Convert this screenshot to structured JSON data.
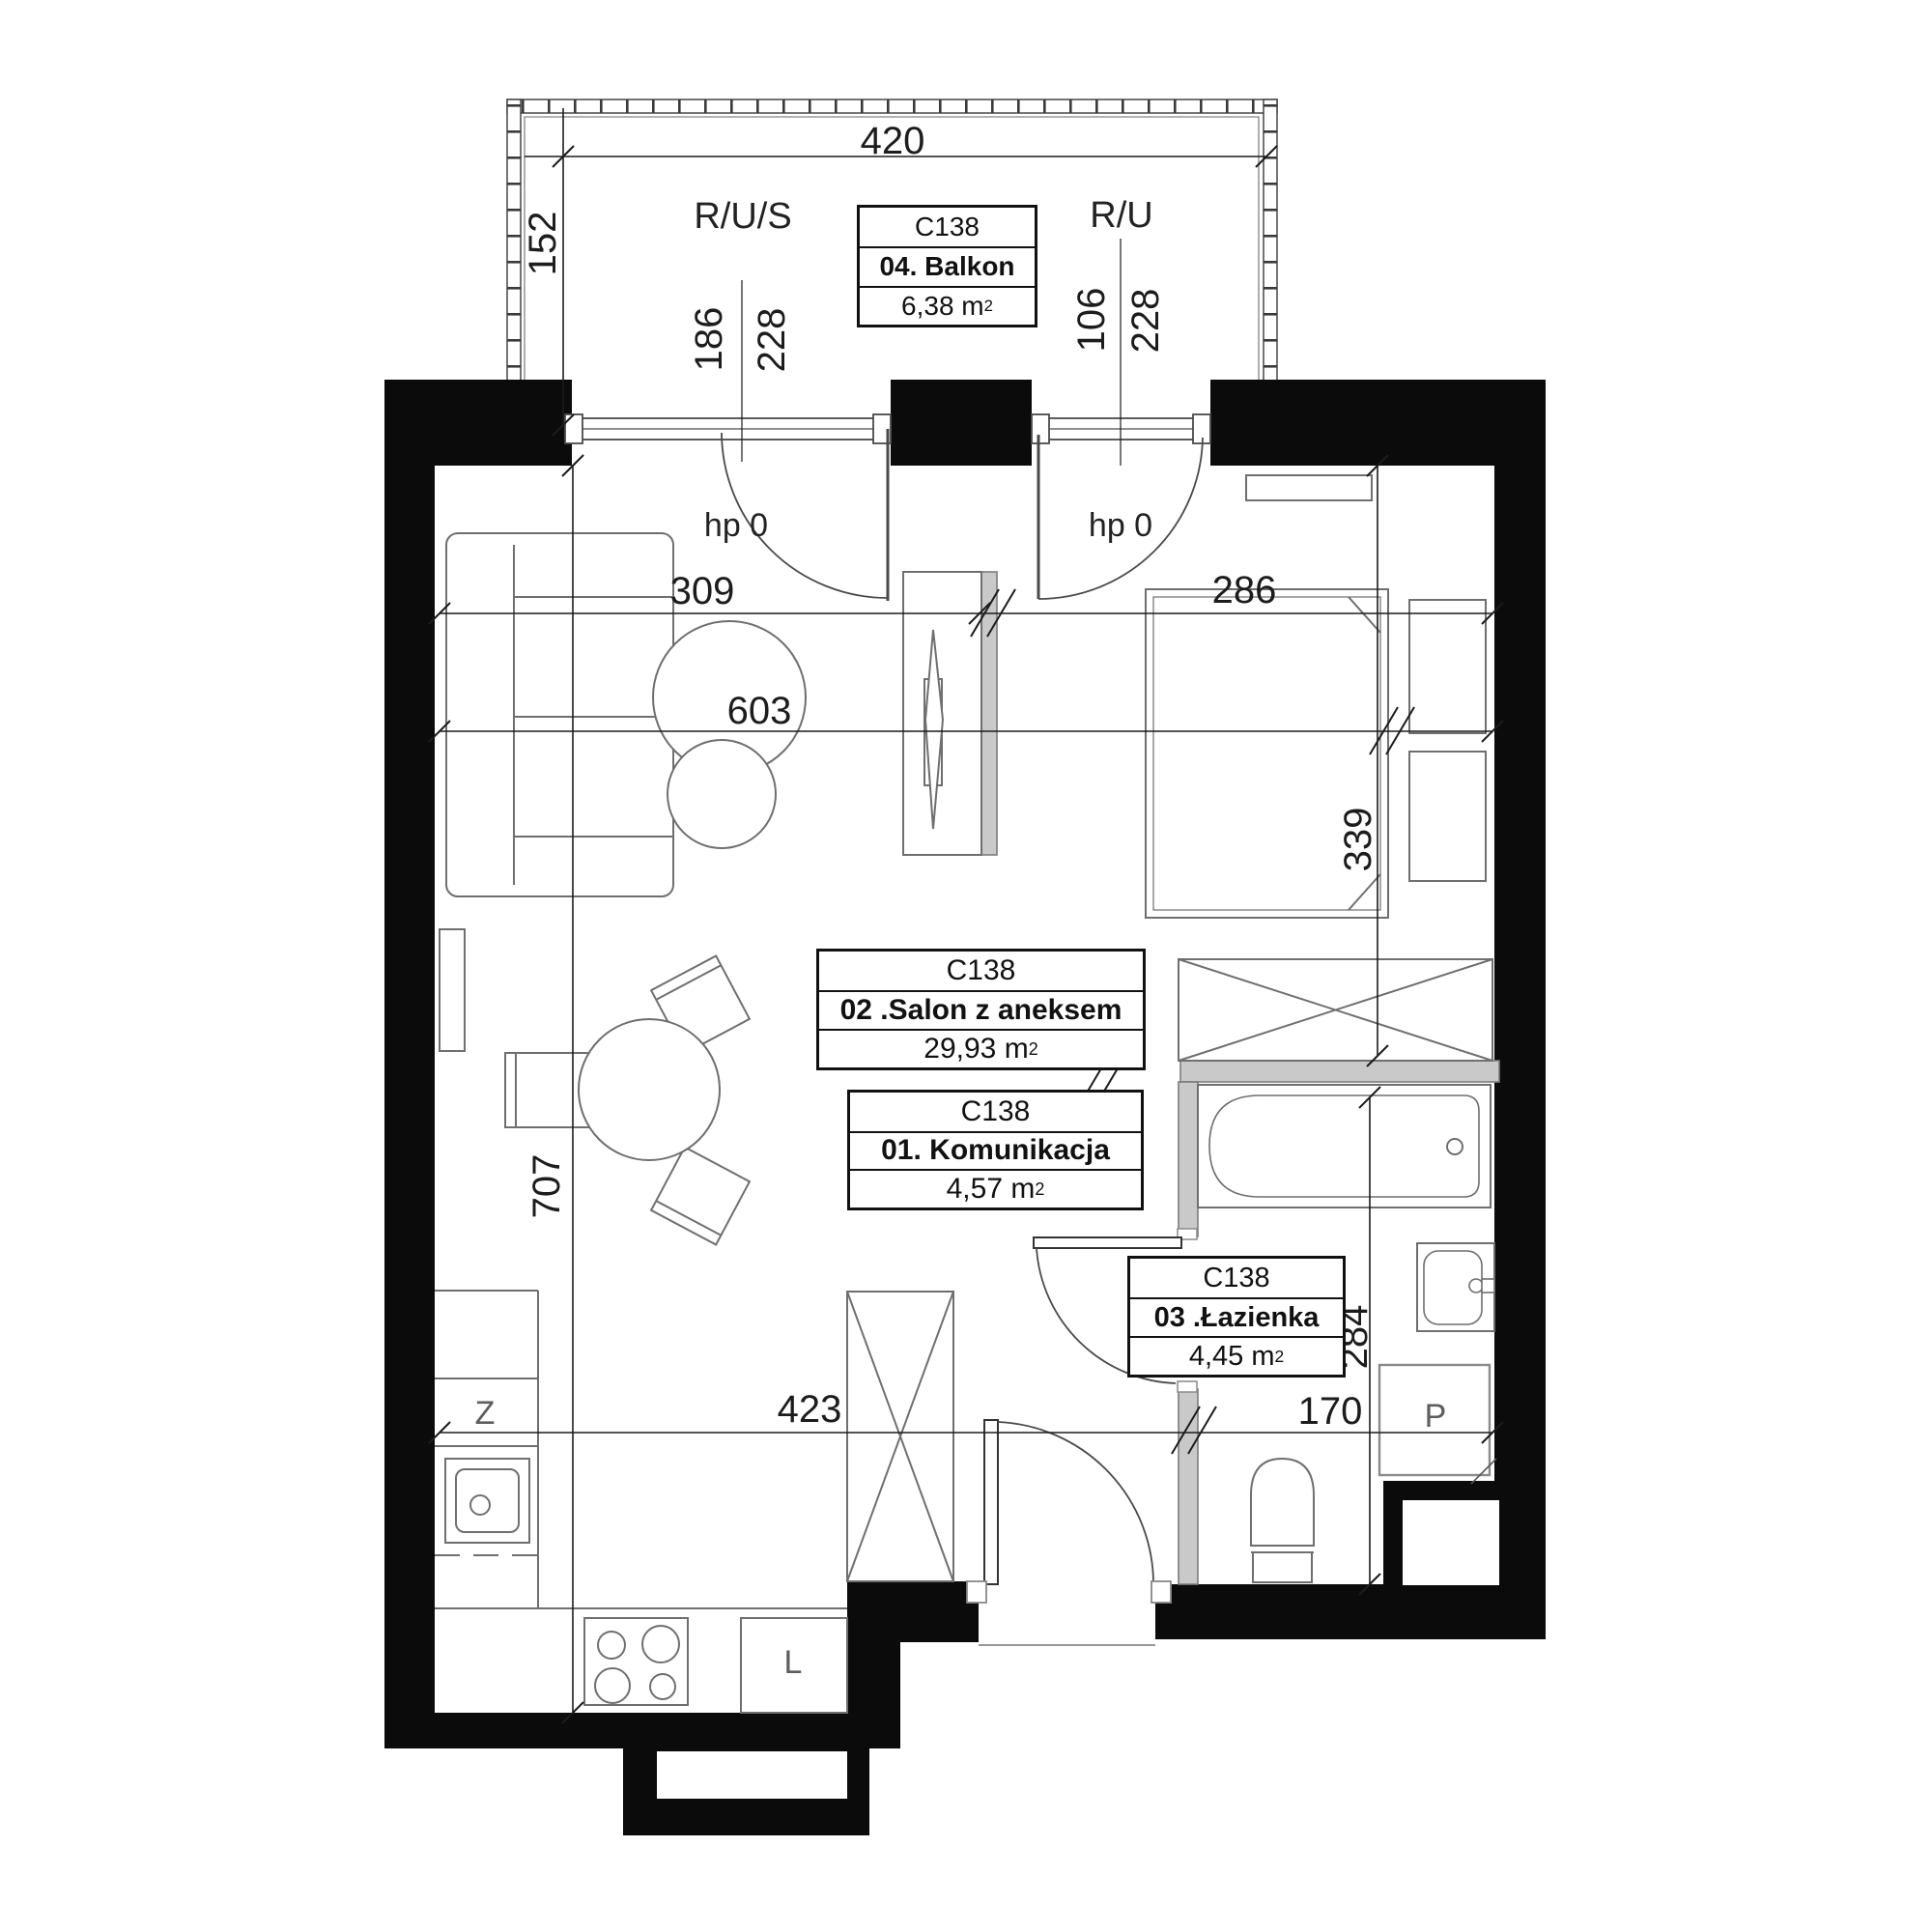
{
  "unit": "C138",
  "room_boxes": [
    {
      "code": "C138",
      "name": "04. Balkon",
      "area": "6,38 m",
      "sup": "2"
    },
    {
      "code": "C138",
      "name": "02 .Salon z aneksem",
      "area": "29,93 m",
      "sup": "2"
    },
    {
      "code": "C138",
      "name": "01. Komunikacja",
      "area": "4,57 m",
      "sup": "2"
    },
    {
      "code": "C138",
      "name": "03 .Łazienka",
      "area": "4,45 m",
      "sup": "2"
    }
  ],
  "dims": {
    "balcony_width": "420",
    "balcony_depth": "152",
    "balcony_left_a": "186",
    "balcony_left_b": "228",
    "balcony_right_a": "106",
    "balcony_right_b": "228",
    "living_width": "309",
    "bedroom_width": "286",
    "total_width": "603",
    "bed_zone_depth": "339",
    "living_depth": "707",
    "kitchen_width": "423",
    "bath_width": "170",
    "bath_depth": "284"
  },
  "annotations": {
    "riser_left": "R/U/S",
    "riser_right": "R/U",
    "door_left": "hp 0",
    "door_right": "hp 0",
    "sink": "Z",
    "fridge": "L",
    "washer": "P"
  },
  "colors": {
    "wall": "#0b0b0b",
    "furniture_line": "#6f6f6f",
    "dim_line": "#1c1c1c",
    "gray_wall": "#c9c9c9"
  }
}
